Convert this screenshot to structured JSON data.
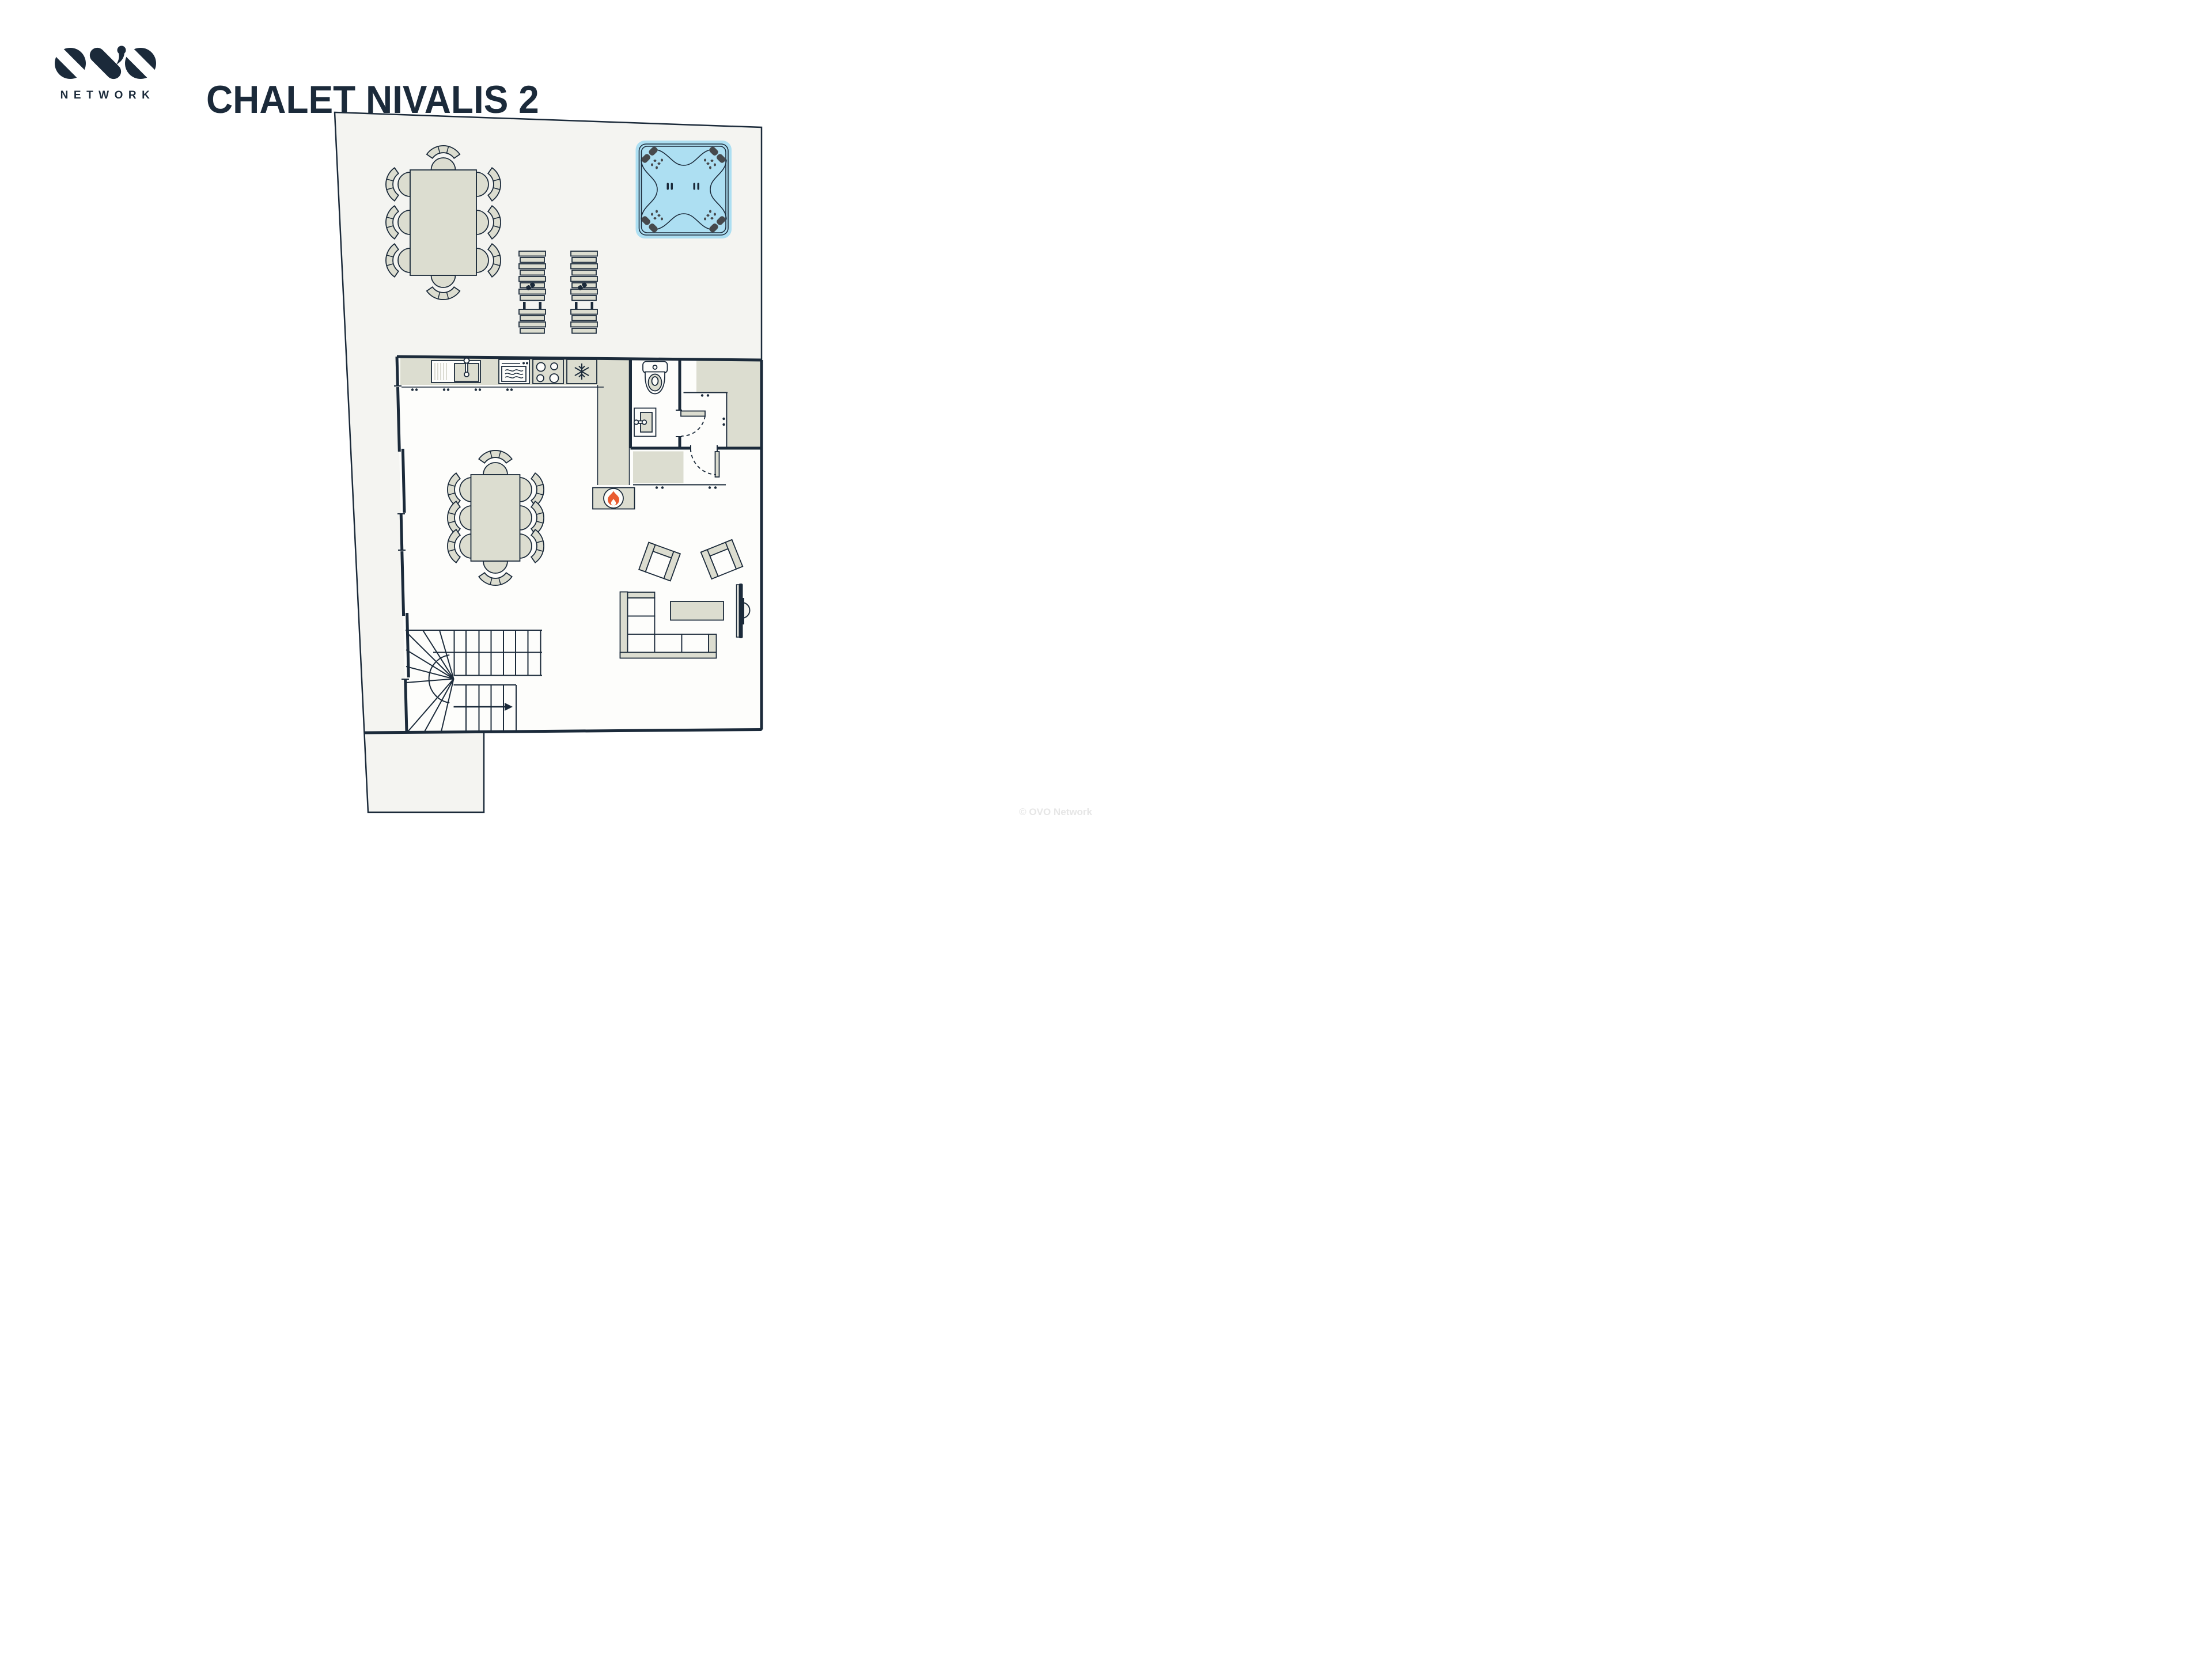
{
  "header": {
    "brand": "OVO",
    "logo_subtext": "NETWORK",
    "title": "CHALET NIVALIS 2"
  },
  "footer": {
    "watermark": "© OVO Network"
  },
  "colors": {
    "navy": "#1b2a3a",
    "beige": "#dcddd0",
    "terrace": "#f4f4f1",
    "paper": "#fdfdfb",
    "tub": "#addff2",
    "jet": "#46494c",
    "flame": "#e95b30",
    "panel": "#e9e9e2",
    "wm": "#e6e6e6"
  },
  "floorplan": {
    "terrace": {
      "features": [
        "outdoor dining table with 8 chairs",
        "2 sun loungers",
        "square hot tub with 4 corner jets"
      ]
    },
    "interior": {
      "features": [
        "kitchen counter with sink, oven, hob and freezer",
        "WC with toilet and washbasin",
        "hallway with closet, shelf and two swing doors",
        "log fireplace",
        "dining table with 8 chairs",
        "U-shaped staircase with winders and direction arrow",
        "2 angled armchairs",
        "corner sofa",
        "coffee table",
        "wall-mounted TV",
        "sliding window bays on left wall"
      ]
    },
    "icons": [
      "flame-icon",
      "snowflake-icon",
      "sunglasses-icon",
      "tap-icon",
      "oven-icon",
      "hob-icon",
      "toilet-icon",
      "stairs-arrow-icon",
      "hot-tub-jet-icon"
    ]
  }
}
